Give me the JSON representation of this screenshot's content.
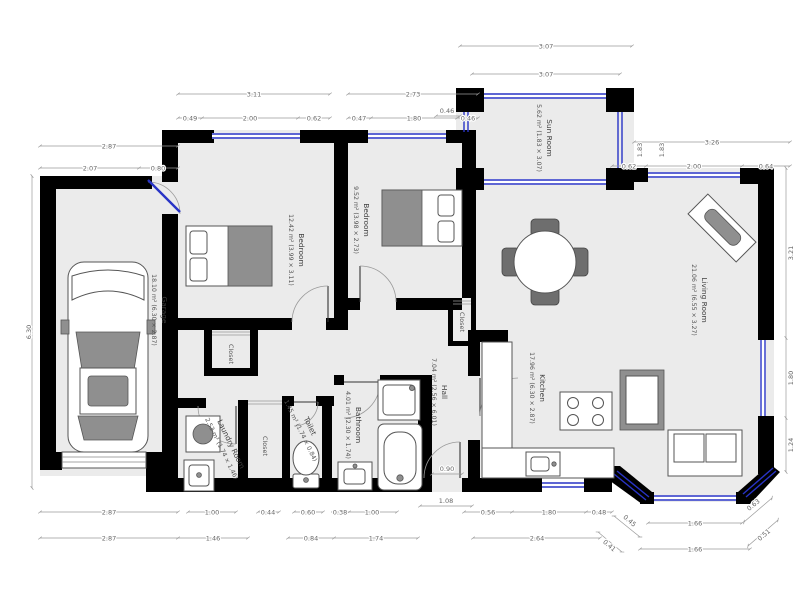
{
  "title": "Floor plan",
  "colors": {
    "wall": "#000000",
    "window": "#2833c6",
    "room_fill": "#ebebeb",
    "dimension": "#9a9a9a"
  },
  "rooms": {
    "garage": {
      "name": "Garage",
      "size": "18.10 m² (6.30 × 2.87)"
    },
    "bedroom1": {
      "name": "Bedroom",
      "size": "12.42 m² (3.99 × 3.11)"
    },
    "bedroom2": {
      "name": "Bedroom",
      "size": "9.52 m² (3.98 × 2.73)"
    },
    "sunroom": {
      "name": "Sun Room",
      "size": "5.62 m² (1.83 × 3.07)"
    },
    "living": {
      "name": "Living Room",
      "size": "21.06 m² (6.55 × 3.27)"
    },
    "kitchen": {
      "name": "Kitchen",
      "size": "17.96 m² (6.30 × 2.87)"
    },
    "hall": {
      "name": "Hall",
      "size": "7.04 m² (2.56 × 6.01)"
    },
    "bathroom": {
      "name": "Bathroom",
      "size": "4.01 m² (2.30 × 1.74)"
    },
    "toilet": {
      "name": "Toilet",
      "size": "1.45 m² (1.74 × 0.84)"
    },
    "laundry": {
      "name": "Laundry Room",
      "size": "2.53 m² (1.74 × 1.46)"
    },
    "closet1": {
      "name": "Closet"
    },
    "closet2": {
      "name": "Closet"
    },
    "closet3": {
      "name": "Closet"
    }
  },
  "dims": {
    "t1": "3.07",
    "t2": "3.07",
    "t3": "3.11",
    "t4": "2.73",
    "t5": "0.49",
    "t6": "2.00",
    "t7": "0.62",
    "t8": "0.47",
    "t9": "1.80",
    "t10": "0.46",
    "g1": "2.87",
    "g2": "2.07",
    "g3": "0.80",
    "tr1": "3.26",
    "tr2": "0.62",
    "tr3": "2.00",
    "tr4": "0.64",
    "v1": "1.83",
    "v2": "1.83",
    "sl": "0.46",
    "left1": "6.30",
    "r1": "3.21",
    "r2": "1.80",
    "r3": "1.24",
    "b1": "2.87",
    "b2": "1.00",
    "b3": "0.44",
    "b4": "0.60",
    "b5": "0.38",
    "b6": "1.00",
    "b7": "1.08",
    "b8": "0.56",
    "b9": "1.80",
    "b10": "0.48",
    "b11": "0.45",
    "b12": "1.66",
    "b13": "0.63",
    "c1": "2.87",
    "c2": "1.46",
    "c3": "0.84",
    "c4": "1.74",
    "c5": "2.64",
    "c6": "0.41",
    "c7": "1.66",
    "c8": "0.51",
    "i1": "0.90"
  }
}
